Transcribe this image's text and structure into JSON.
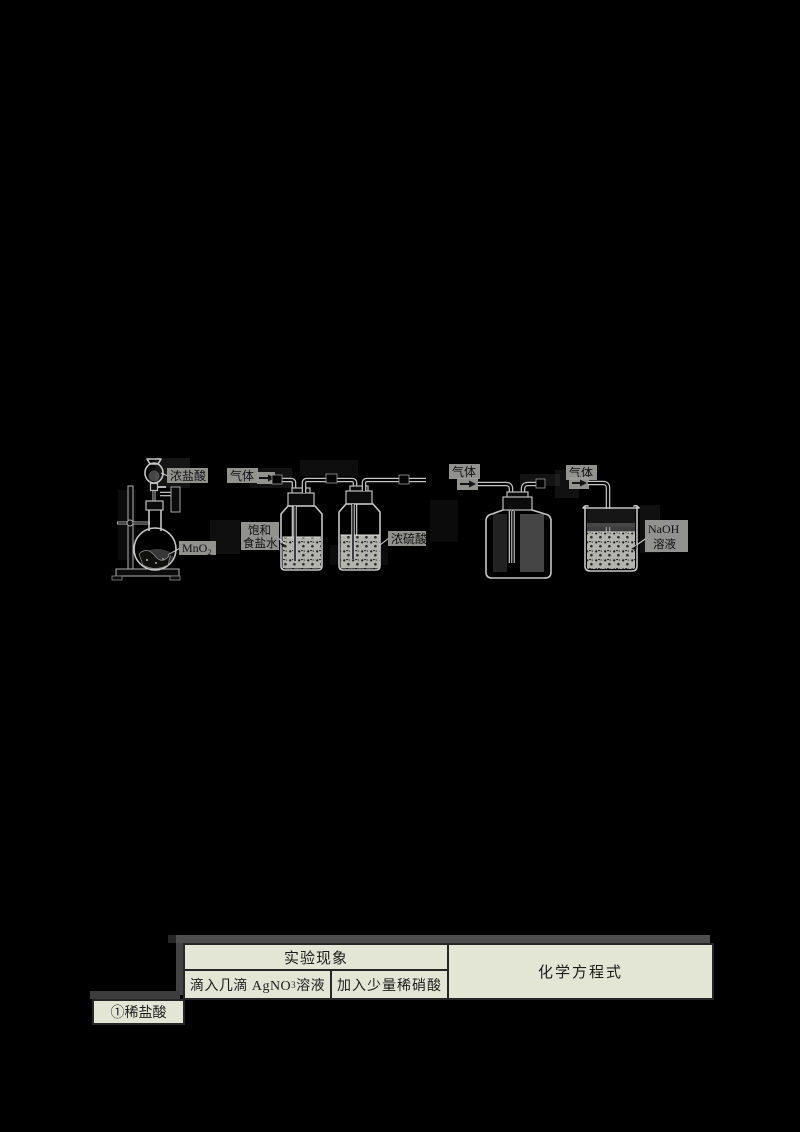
{
  "page": {
    "background": "#000000"
  },
  "colors": {
    "table_bg": "#e3e6d5",
    "table_border": "#262626",
    "line_art": "#c6c6c6",
    "label_patch": "#9d9d9a"
  },
  "diagram": {
    "generator": {
      "funnel_label": "浓盐酸",
      "flask_label_base": "MnO",
      "flask_label_sub": "2"
    },
    "washing": {
      "gas_label": "气体",
      "bottle1_label_line1": "饱和",
      "bottle1_label_line2": "食盐水",
      "bottle2_label": "浓硫酸"
    },
    "collection": {
      "gas_label": "气体"
    },
    "absorption": {
      "gas_label": "气体",
      "solution_label_line1": "NaOH",
      "solution_label_line2": "溶液"
    }
  },
  "table": {
    "header_phenomena": "实验现象",
    "header_equation": "化学方程式",
    "sub_col1_prefix": "滴入几滴 AgNO",
    "sub_col1_sub": "3",
    "sub_col1_suffix": "溶液",
    "sub_col2": "加入少量稀硝酸",
    "row1_label": "①稀盐酸"
  }
}
